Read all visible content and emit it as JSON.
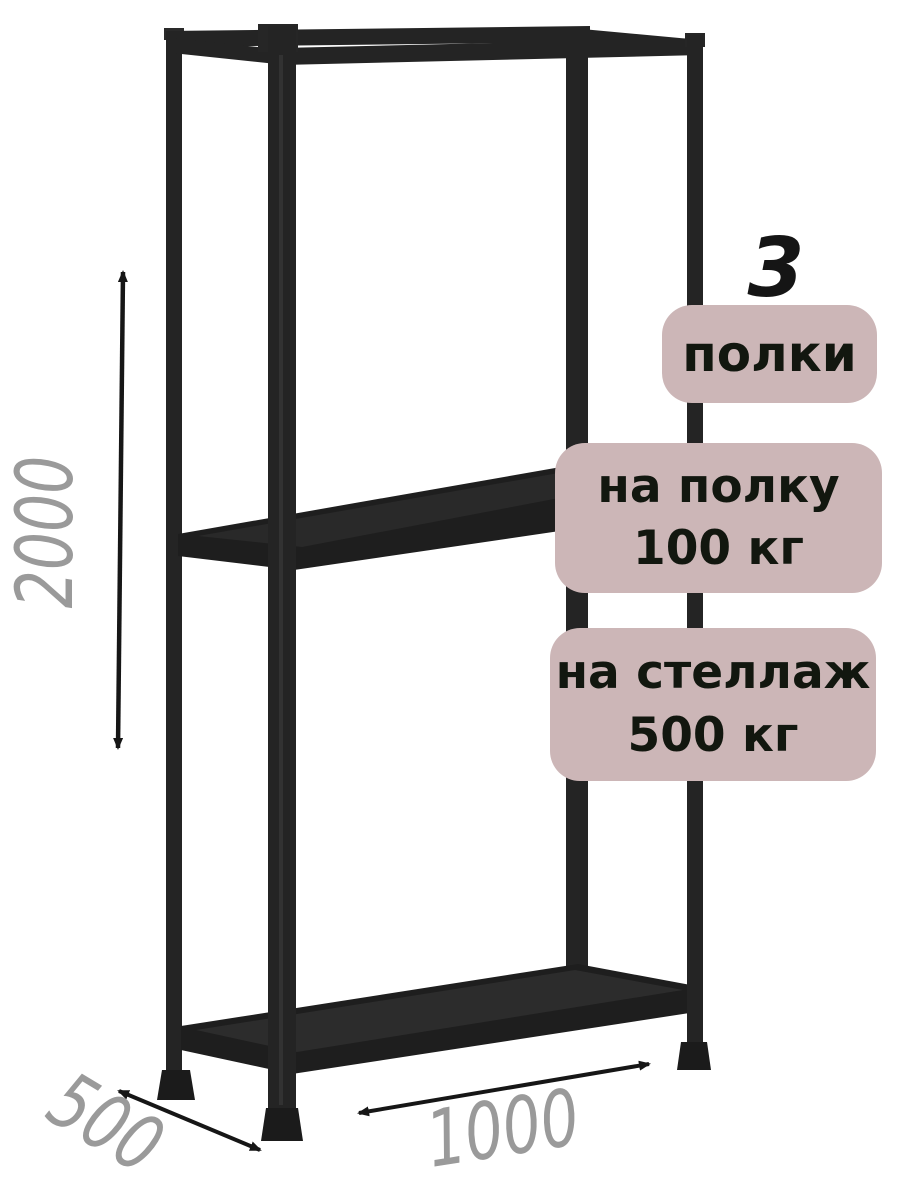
{
  "product": {
    "description": "boltless metal shelving rack, 3D render with dimension annotations",
    "shelf_count": "3",
    "badges": {
      "shelves_label": "полки",
      "per_shelf_line1": "на полку",
      "per_shelf_line2": "100 кг",
      "per_rack_line1": "на стеллаж",
      "per_rack_line2": "500 кг"
    },
    "dimensions": {
      "height_mm": "2000",
      "depth_mm": "500",
      "width_mm": "1000"
    },
    "colors": {
      "badge_bg": "#ccb6b7",
      "badge_text": "#12170f",
      "dimension_label": "#9a9a9a",
      "rack_metal": "#242424",
      "arrow": "#161616",
      "background": "#ffffff"
    }
  }
}
